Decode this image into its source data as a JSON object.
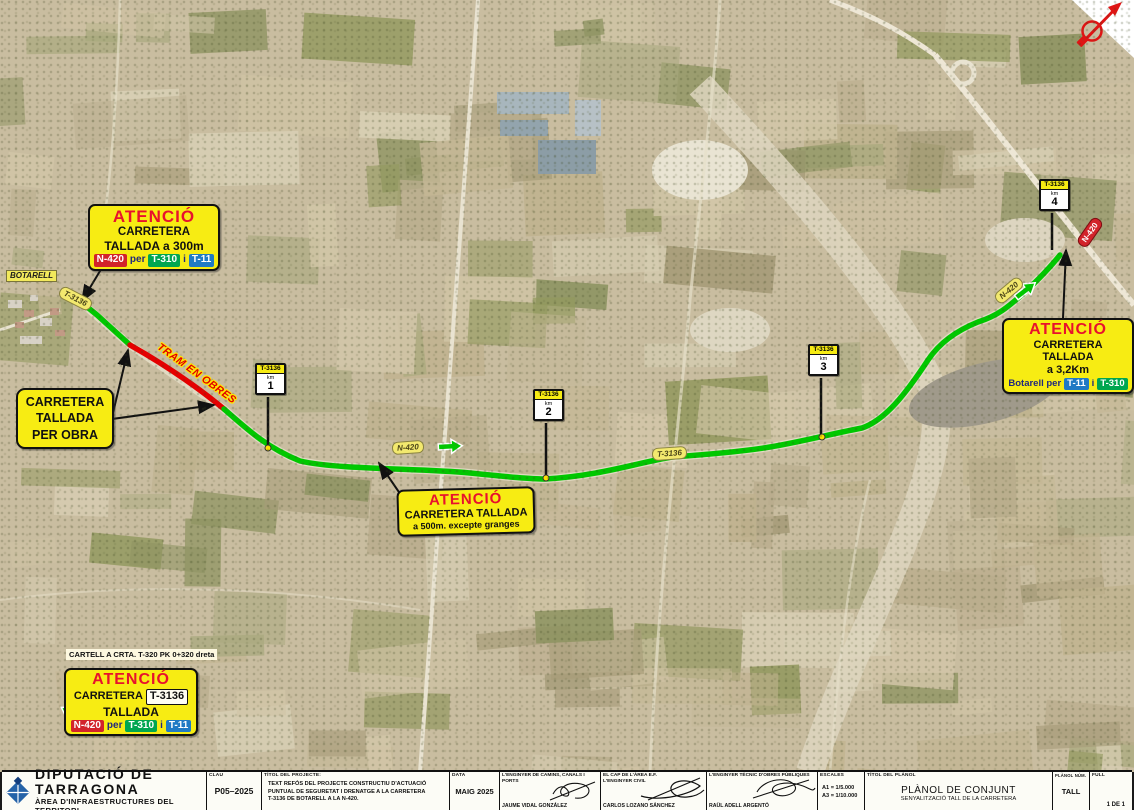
{
  "map": {
    "town": "BOTARELL",
    "tram_en_obres": "TRAM EN OBRES",
    "cartell_note": "CARTELL A CRTA. T-320 PK 0+320 dreta",
    "road_labels": {
      "t3136_a": "T-3136",
      "t3136_b": "T-3136",
      "n420_a": "N-420",
      "n420_b": "N-420",
      "n420_red": "N-420"
    },
    "km_posts": [
      {
        "road": "T-3136",
        "km_label": "km",
        "num": "1"
      },
      {
        "road": "T-3136",
        "km_label": "km",
        "num": "2"
      },
      {
        "road": "T-3136",
        "km_label": "km",
        "num": "3"
      },
      {
        "road": "T-3136",
        "km_label": "km",
        "num": "4"
      }
    ]
  },
  "signs": {
    "attn_botarell": {
      "title": "ATENCIÓ",
      "line1": "CARRETERA",
      "line2": "TALLADA a 300m",
      "b1": "N-420",
      "sep1": "per",
      "b2": "T-310",
      "sep2": "i",
      "b3": "T-11"
    },
    "closed_box": {
      "line1": "CARRETERA",
      "line2": "TALLADA",
      "line3": "PER OBRA"
    },
    "attn_mid": {
      "title": "ATENCIÓ",
      "line1": "CARRETERA TALLADA",
      "line2": "a 500m. excepte granges"
    },
    "attn_right": {
      "title": "ATENCIÓ",
      "line1": "CARRETERA TALLADA",
      "line2": "a 3,2Km",
      "pre": "Botarell per",
      "b1": "T-11",
      "sep": "i",
      "b2": "T-310"
    },
    "attn_bottom": {
      "title": "ATENCIÓ",
      "line1a": "CARRETERA",
      "line1b": "T-3136",
      "line2": "TALLADA",
      "b1": "N-420",
      "sep1": "per",
      "b2": "T-310",
      "sep2": "i",
      "b3": "T-11"
    }
  },
  "title_block": {
    "org_name": "DIPUTACIÓ DE TARRAGONA",
    "org_dept": "ÀREA D'INFRAESTRUCTURES DEL TERRITORI",
    "clau_label": "CLAU",
    "clau_value": "P05–2025",
    "project_label": "TÍTOL DEL PROJECTE:",
    "project_line1": "TEXT REFÓS DEL PROJECTE CONSTRUCTIU D'ACTUACIÓ",
    "project_line2": "PUNTUAL DE SEGURETAT I DRENATGE A LA CARRETERA",
    "project_line3": "T-3136 DE BOTARELL A LA N-420.",
    "date_label": "DATA",
    "date_value": "MAIG 2025",
    "sig1_role": "L'ENGINYER DE CAMINS, CANALS I PORTS",
    "sig1_name": "JAUME VIDAL GONZÁLEZ",
    "sig2_role1": "EL CAP DE L'ÀREA E.F.",
    "sig2_role2": "L'ENGINYER CIVIL",
    "sig2_name": "CARLOS LOZANO SÁNCHEZ",
    "sig3_role": "L'ENGINYER TÈCNIC D'OBRES PÚBLIQUES",
    "sig3_name": "RAÜL ADELL ARGENTÓ",
    "scales_label": "ESCALES",
    "scale_a1": "A1 = 1/5.000",
    "scale_a3": "A3 = 1/10.000",
    "plan_label": "TÍTOL DEL PLÀNOL",
    "plan_title": "PLÀNOL DE CONJUNT",
    "plan_subtitle": "SENYALITZACIÓ TALL DE LA CARRETERA",
    "plan_num_label": "PLÀNOL NÚM.",
    "plan_num_value": "TALL",
    "sheet_label": "FULL",
    "sheet_value": "1  DE  1"
  }
}
